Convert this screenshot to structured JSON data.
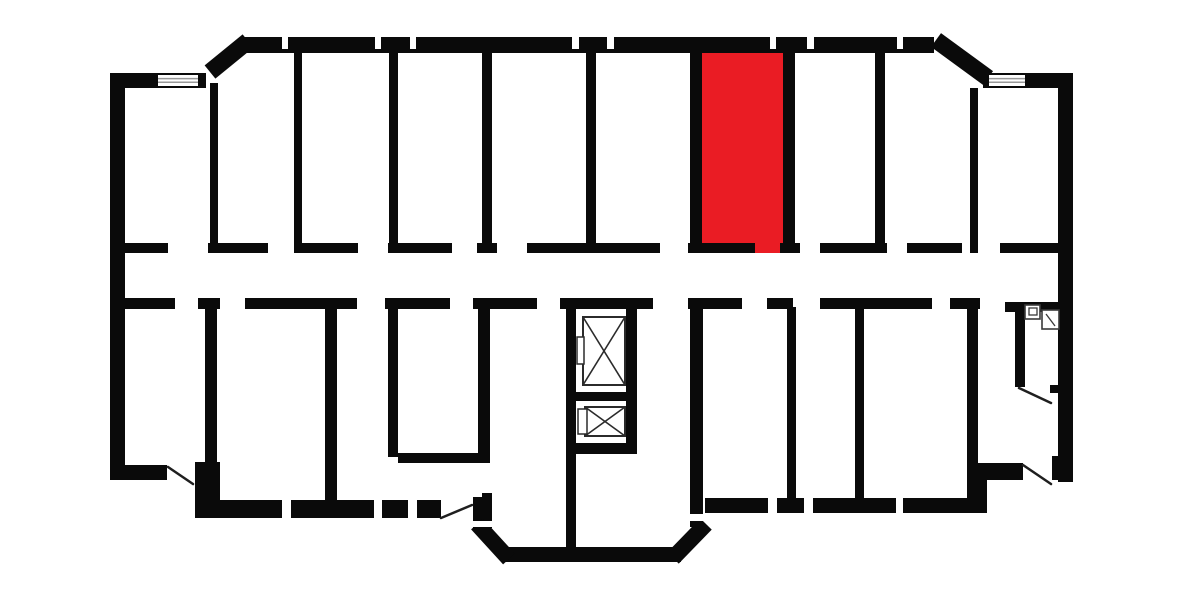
{
  "plan": {
    "width": 1184,
    "height": 592,
    "colors": {
      "background": "#ffffff",
      "walls": "#0a0a0a",
      "highlight": "#ea1c24",
      "thin_line": "#1f1f1f",
      "fixture_stroke": "#3a3a3a",
      "window_line": "#999999",
      "elevator_stroke": "#2b2b2b"
    },
    "highlight_room": {
      "rect": [
        702,
        53,
        81,
        191
      ],
      "door_tab": [
        755,
        243,
        25,
        10
      ]
    },
    "wall_rects": [
      [
        240,
        37,
        694,
        16
      ],
      [
        110,
        73,
        96,
        15
      ],
      [
        110,
        73,
        15,
        407
      ],
      [
        110,
        465,
        57,
        15
      ],
      [
        195,
        462,
        25,
        56
      ],
      [
        200,
        500,
        82,
        18
      ],
      [
        291,
        500,
        83,
        18
      ],
      [
        382,
        500,
        26,
        18
      ],
      [
        417,
        500,
        24,
        18
      ],
      [
        473,
        497,
        19,
        31
      ],
      [
        482,
        493,
        10,
        6
      ],
      [
        503,
        547,
        178,
        15
      ],
      [
        690,
        307,
        13,
        220
      ],
      [
        705,
        498,
        63,
        15
      ],
      [
        777,
        498,
        27,
        15
      ],
      [
        813,
        498,
        83,
        15
      ],
      [
        903,
        498,
        64,
        15
      ],
      [
        967,
        463,
        20,
        50
      ],
      [
        978,
        463,
        45,
        17
      ],
      [
        1052,
        456,
        11,
        24
      ],
      [
        1058,
        73,
        15,
        409
      ],
      [
        983,
        73,
        90,
        15
      ],
      [
        210,
        83,
        8,
        170
      ],
      [
        294,
        53,
        8,
        200
      ],
      [
        389,
        53,
        9,
        200
      ],
      [
        482,
        53,
        10,
        200
      ],
      [
        586,
        53,
        10,
        200
      ],
      [
        690,
        50,
        12,
        203
      ],
      [
        783,
        52,
        12,
        201
      ],
      [
        875,
        53,
        10,
        200
      ],
      [
        970,
        88,
        8,
        165
      ],
      [
        110,
        243,
        58,
        10
      ],
      [
        208,
        243,
        60,
        10
      ],
      [
        298,
        243,
        60,
        10
      ],
      [
        388,
        243,
        64,
        10
      ],
      [
        477,
        243,
        20,
        10
      ],
      [
        527,
        243,
        133,
        10
      ],
      [
        688,
        243,
        67,
        10
      ],
      [
        780,
        243,
        20,
        10
      ],
      [
        820,
        243,
        67,
        10
      ],
      [
        907,
        243,
        55,
        10
      ],
      [
        1000,
        243,
        58,
        10
      ],
      [
        125,
        298,
        50,
        11
      ],
      [
        198,
        298,
        22,
        11
      ],
      [
        245,
        298,
        112,
        11
      ],
      [
        385,
        298,
        65,
        11
      ],
      [
        473,
        298,
        64,
        11
      ],
      [
        560,
        298,
        93,
        11
      ],
      [
        688,
        298,
        54,
        11
      ],
      [
        767,
        298,
        26,
        11
      ],
      [
        820,
        298,
        112,
        11
      ],
      [
        950,
        298,
        30,
        11
      ],
      [
        1005,
        302,
        58,
        10
      ],
      [
        205,
        307,
        12,
        155
      ],
      [
        325,
        307,
        12,
        196
      ],
      [
        388,
        307,
        10,
        150
      ],
      [
        478,
        307,
        12,
        156
      ],
      [
        398,
        453,
        92,
        10
      ],
      [
        566,
        302,
        10,
        253
      ],
      [
        626,
        302,
        11,
        150
      ],
      [
        566,
        443,
        71,
        11
      ],
      [
        576,
        392,
        50,
        9
      ],
      [
        787,
        307,
        9,
        196
      ],
      [
        855,
        307,
        9,
        196
      ],
      [
        967,
        307,
        11,
        156
      ],
      [
        1015,
        310,
        10,
        77
      ],
      [
        1050,
        385,
        13,
        8
      ]
    ],
    "chamfer_walls": [
      [
        210,
        72,
        248,
        41,
        17
      ],
      [
        936,
        40,
        988,
        78,
        17
      ],
      [
        477,
        524,
        509,
        559,
        16
      ],
      [
        673,
        558,
        706,
        524,
        16
      ]
    ],
    "wall_opening_slits": [
      [
        282,
        37,
        6,
        12
      ],
      [
        375,
        37,
        6,
        12
      ],
      [
        410,
        37,
        6,
        12
      ],
      [
        572,
        37,
        7,
        12
      ],
      [
        607,
        37,
        7,
        12
      ],
      [
        770,
        37,
        6,
        12
      ],
      [
        807,
        37,
        7,
        12
      ],
      [
        897,
        37,
        6,
        12
      ],
      [
        471,
        521,
        23,
        6
      ],
      [
        688,
        514,
        17,
        7
      ]
    ],
    "windows": [
      {
        "rect": [
          158,
          75,
          40,
          11
        ]
      },
      {
        "rect": [
          989,
          75,
          36,
          11
        ]
      }
    ],
    "door_swings": [
      [
        168,
        467,
        193,
        484
      ],
      [
        441,
        518,
        472,
        505
      ],
      [
        1023,
        465,
        1051,
        484
      ],
      [
        1019,
        388,
        1051,
        403
      ]
    ],
    "elevators": [
      {
        "box": [
          583,
          317,
          42,
          68
        ],
        "door": [
          577,
          337,
          7,
          27
        ]
      },
      {
        "box": [
          585,
          407,
          40,
          29
        ],
        "door": [
          578,
          409,
          9,
          25
        ]
      }
    ],
    "bathroom_fixtures": {
      "toilet_outer": [
        1025,
        305,
        15,
        14
      ],
      "toilet_inner": [
        1029,
        308,
        8,
        7
      ],
      "sink_outer": [
        1042,
        310,
        17,
        19
      ],
      "sink_diag": [
        1046,
        314,
        1055,
        326
      ]
    }
  }
}
